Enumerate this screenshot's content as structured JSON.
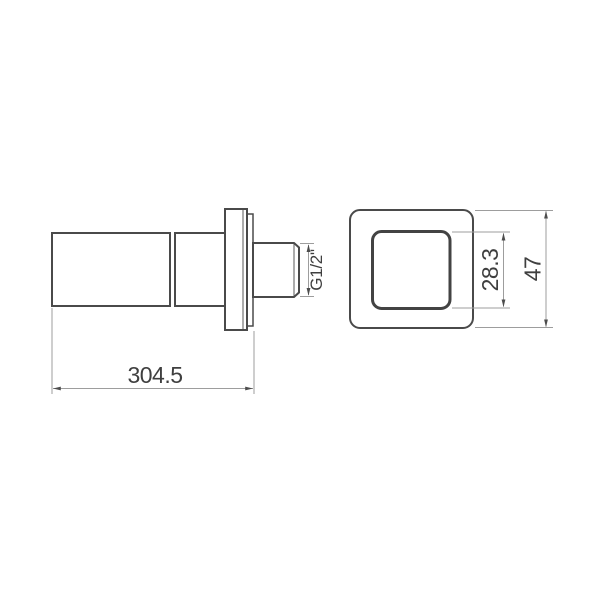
{
  "drawing": {
    "labels": {
      "overall_length": "304.5",
      "thread_size": "G1/2\"",
      "inner_square_size": "28.3",
      "outer_square_size": "47"
    },
    "colors": {
      "part_outline": "#4a4a4a",
      "dimension_lines": "#9d9d9d",
      "dimension_text": "#3f3f3f",
      "background": "#ffffff"
    }
  }
}
